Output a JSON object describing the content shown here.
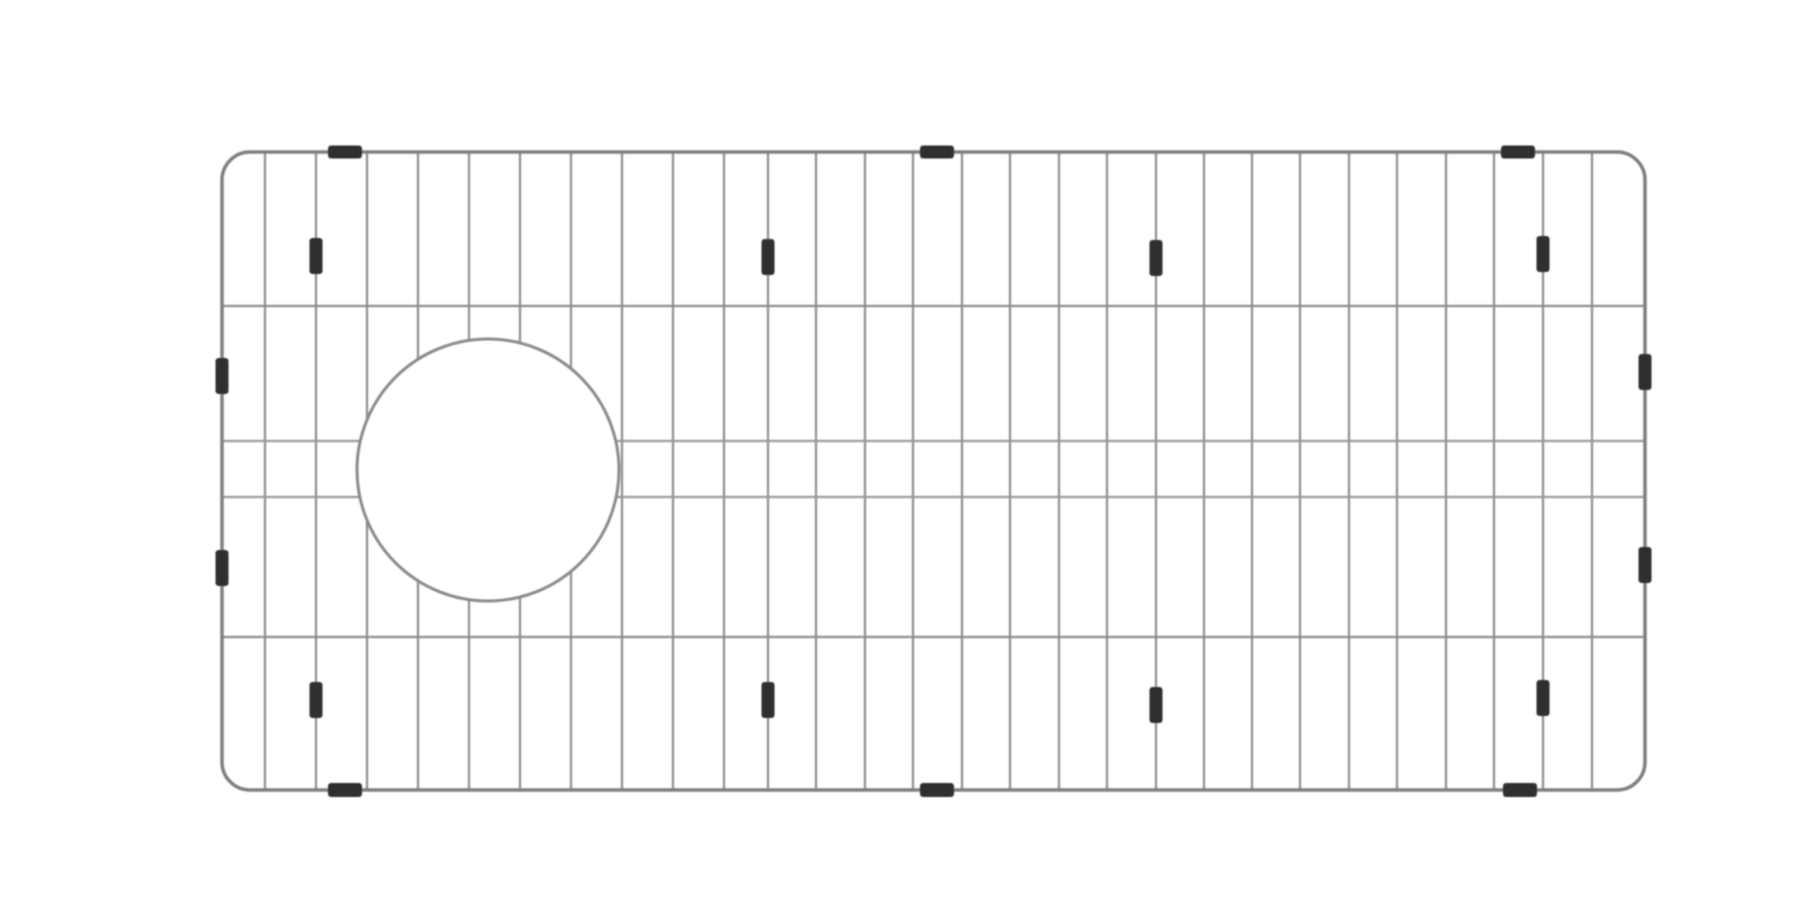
{
  "page": {
    "background_color": "#ffffff",
    "subject": "sink-bottom-grid-with-drain-opening",
    "style": "grayscale-line-drawing"
  },
  "drawing": {
    "colors": {
      "frame_stroke": "#7f7f7f",
      "wire_stroke": "#8c8c8c",
      "inner_horizontal_stroke": "#979797",
      "hole_stroke": "#8a8a8a",
      "hole_fill": "#ffffff",
      "foot_fill": "#2f2f2f"
    },
    "frame": {
      "x": 222,
      "y": 152,
      "width": 1423,
      "height": 638,
      "corner_radius": 28,
      "stroke_width": 3.5
    },
    "vertical_wires": {
      "stroke_width": 2.2,
      "x_positions": [
        265,
        316,
        367,
        418,
        469,
        520,
        571,
        622,
        673,
        724,
        768,
        816,
        865,
        913,
        962,
        1010,
        1059,
        1107,
        1156,
        1204,
        1252,
        1300,
        1349,
        1397,
        1446,
        1494,
        1543,
        1592
      ]
    },
    "horizontal_wires": {
      "stroke_width": 2.2,
      "y_positions": [
        306,
        441,
        497,
        637
      ]
    },
    "drain_hole": {
      "cx": 488,
      "cy": 470,
      "r": 131,
      "stroke_width": 3
    },
    "feet": [
      {
        "name": "foot-top-frame",
        "orientation": "horizontal",
        "w": 34,
        "h": 13,
        "points": [
          {
            "x": 345,
            "y": 152
          },
          {
            "x": 937,
            "y": 152
          },
          {
            "x": 1518,
            "y": 152
          }
        ]
      },
      {
        "name": "foot-bottom-frame",
        "orientation": "horizontal",
        "w": 34,
        "h": 14,
        "points": [
          {
            "x": 345,
            "y": 790
          },
          {
            "x": 937,
            "y": 790
          },
          {
            "x": 1520,
            "y": 790
          }
        ]
      },
      {
        "name": "foot-left-frame",
        "orientation": "vertical",
        "w": 13,
        "h": 36,
        "points": [
          {
            "x": 222,
            "y": 376
          },
          {
            "x": 222,
            "y": 568
          }
        ]
      },
      {
        "name": "foot-right-frame",
        "orientation": "vertical",
        "w": 13,
        "h": 36,
        "points": [
          {
            "x": 1645,
            "y": 372
          },
          {
            "x": 1645,
            "y": 565
          }
        ]
      },
      {
        "name": "foot-wire-upper",
        "orientation": "vertical",
        "w": 13,
        "h": 36,
        "points": [
          {
            "x": 316,
            "y": 256
          },
          {
            "x": 768,
            "y": 257
          },
          {
            "x": 1156,
            "y": 258
          },
          {
            "x": 1543,
            "y": 254
          }
        ]
      },
      {
        "name": "foot-wire-lower",
        "orientation": "vertical",
        "w": 13,
        "h": 36,
        "points": [
          {
            "x": 316,
            "y": 700
          },
          {
            "x": 768,
            "y": 700
          },
          {
            "x": 1156,
            "y": 705
          },
          {
            "x": 1543,
            "y": 698
          }
        ]
      }
    ]
  }
}
